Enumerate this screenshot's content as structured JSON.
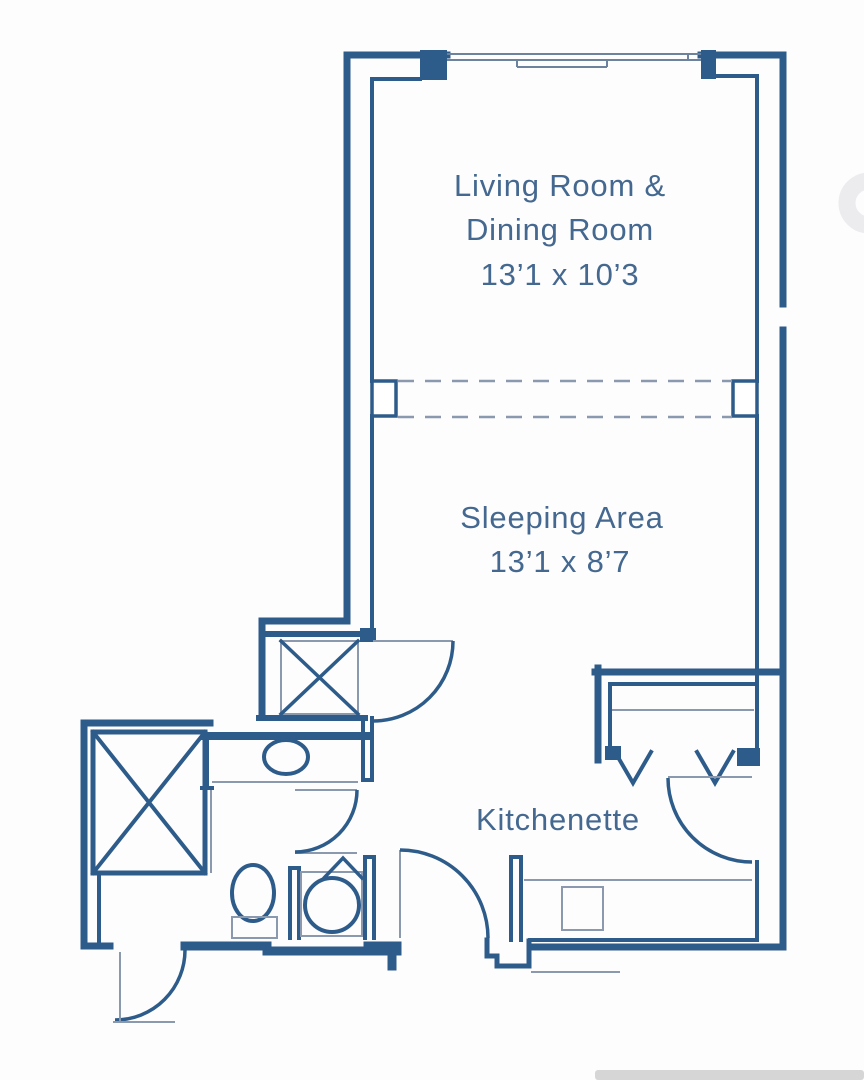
{
  "palette": {
    "wall": "#2e5c8a",
    "thin": "#8a99ad",
    "window_line": "#6d829c",
    "text": "#44688f",
    "watermark": "#ececef",
    "footer_bar": "#d6d6d6",
    "background": "#fdfdfe"
  },
  "floorplan": {
    "type": "studio-apartment-floor-plan",
    "rooms": [
      {
        "id": "living-dining",
        "label_line1": "Living Room &",
        "label_line2": "Dining Room",
        "dimensions": "13’1 x 10’3"
      },
      {
        "id": "sleeping-area",
        "label": "Sleeping Area",
        "dimensions": "13’1 x 8’7"
      },
      {
        "id": "kitchenette",
        "label": "Kitchenette"
      }
    ],
    "fixtures": [
      "top-window",
      "dashed-room-divider",
      "crossed-box-closet",
      "crossed-box-shower",
      "bathroom-sink",
      "toilet",
      "shower-stall-basin",
      "bifold-closet-arrows",
      "kitchen-counter-sink",
      "five-door-swings"
    ]
  }
}
